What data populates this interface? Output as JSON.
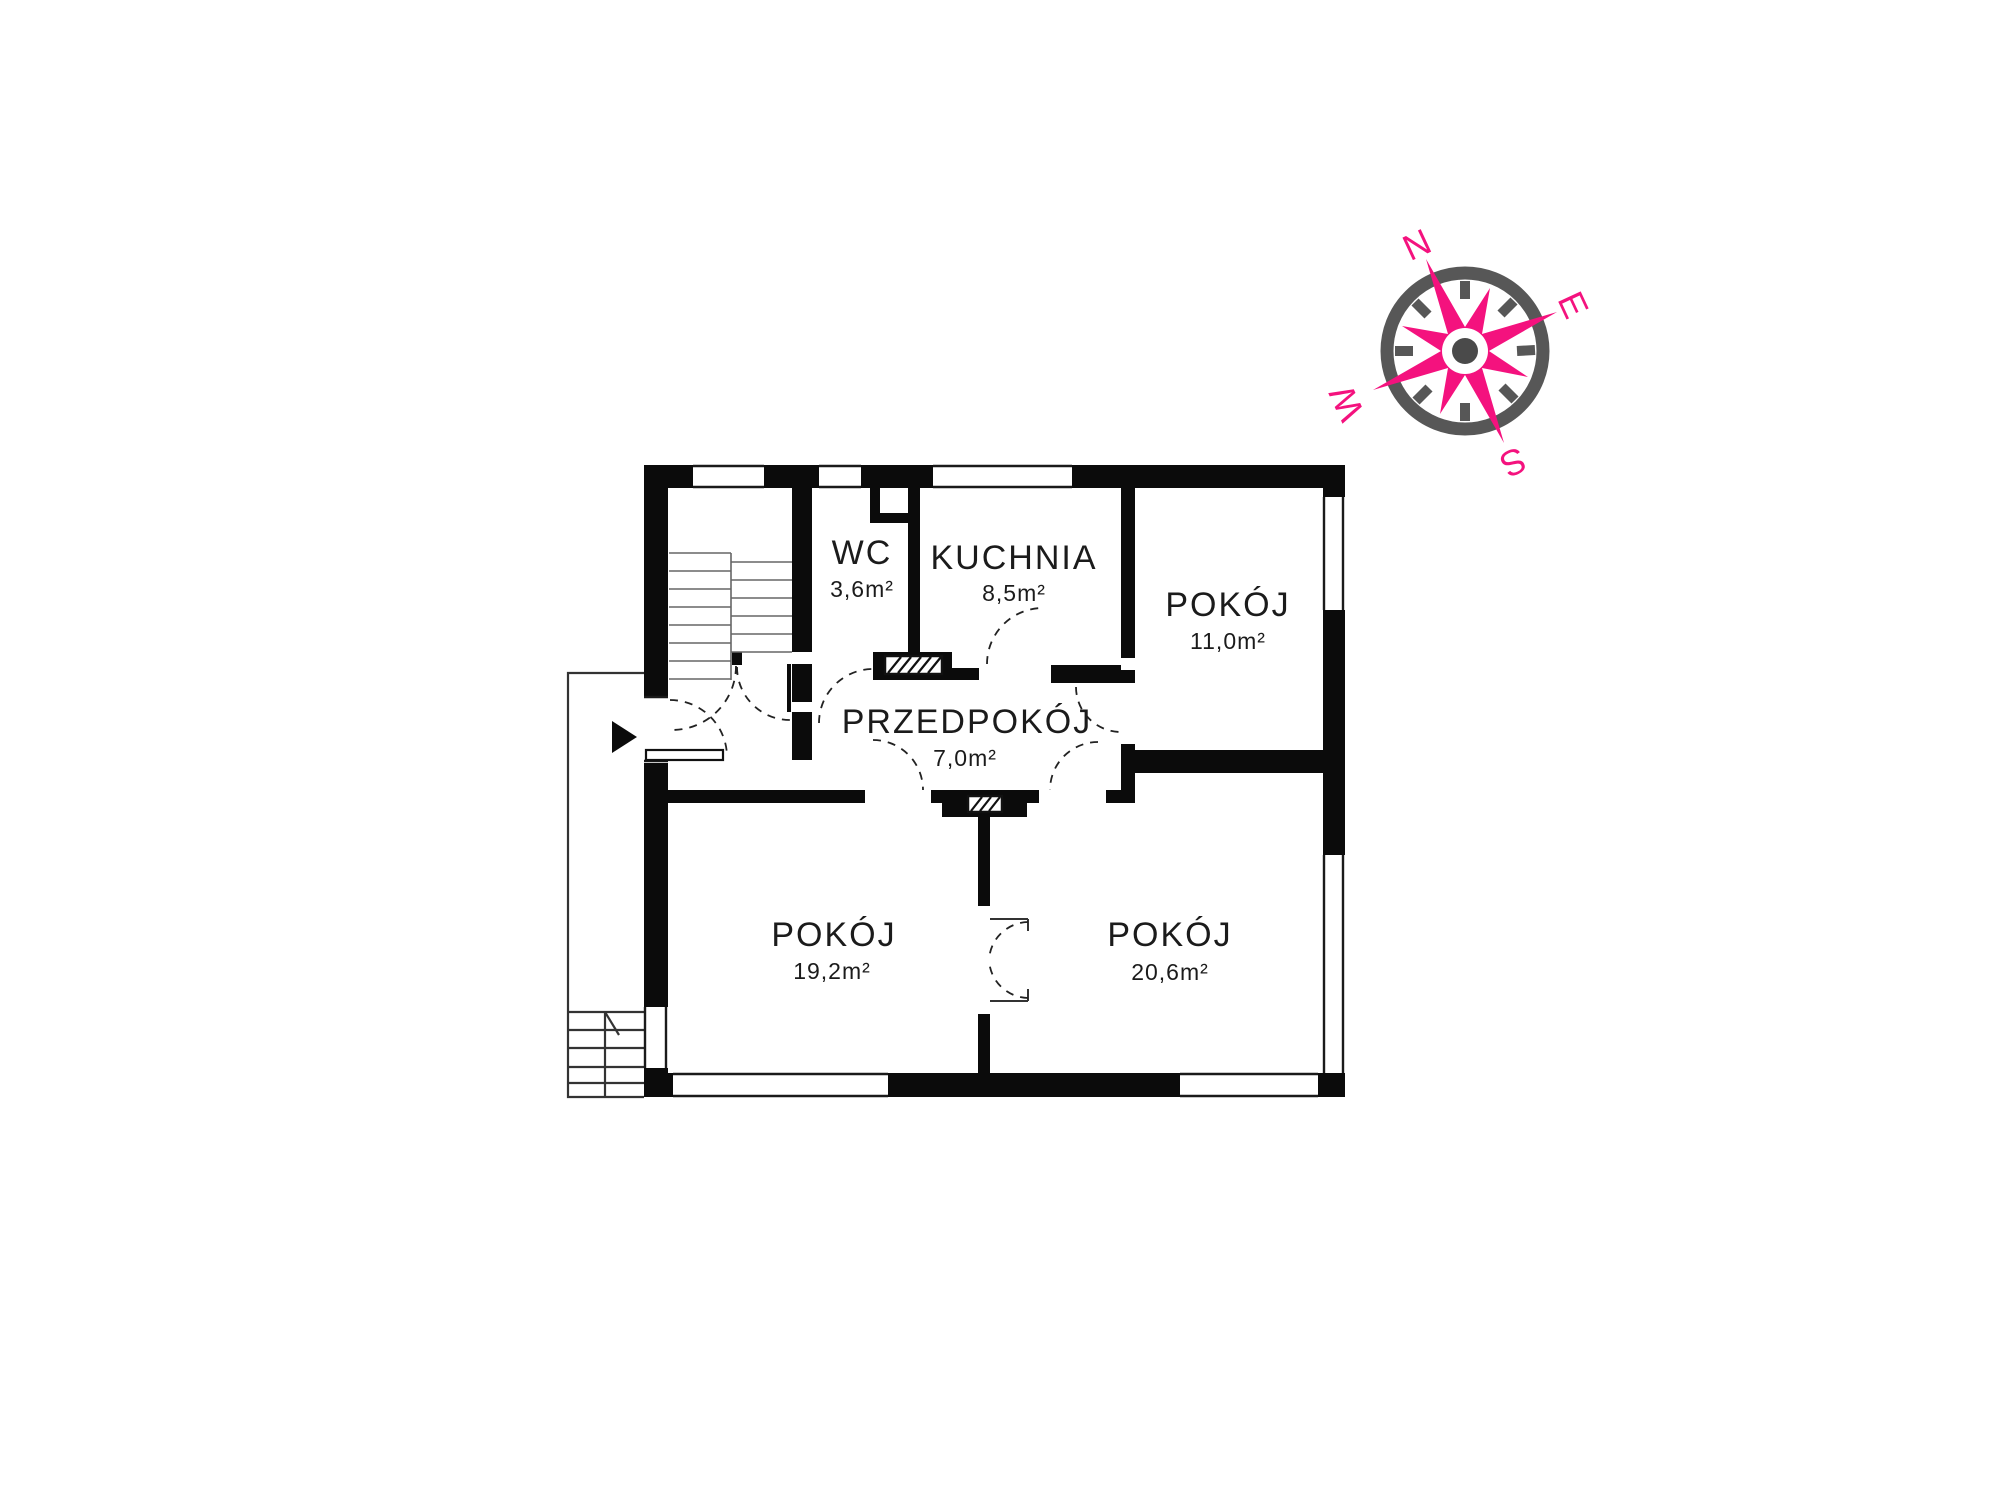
{
  "title": "floor-plan",
  "colors": {
    "wall": "#0b0b0b",
    "accent_pink": "#f4127e",
    "compass_gray": "#575757",
    "text": "#1b1b1b",
    "background": "#ffffff"
  },
  "compass": {
    "north": "N",
    "east": "E",
    "south": "S",
    "west": "W"
  },
  "rooms": [
    {
      "id": "wc",
      "name": "WC",
      "area": "3,6m²"
    },
    {
      "id": "kuchnia",
      "name": "KUCHNIA",
      "area": "8,5m²"
    },
    {
      "id": "pokoj-1",
      "name": "POKÓJ",
      "area": "11,0m²"
    },
    {
      "id": "przedpokoj",
      "name": "PRZEDPOKÓJ",
      "area": "7,0m²"
    },
    {
      "id": "pokoj-2",
      "name": "POKÓJ",
      "area": "19,2m²"
    },
    {
      "id": "pokoj-3",
      "name": "POKÓJ",
      "area": "20,6m²"
    }
  ]
}
